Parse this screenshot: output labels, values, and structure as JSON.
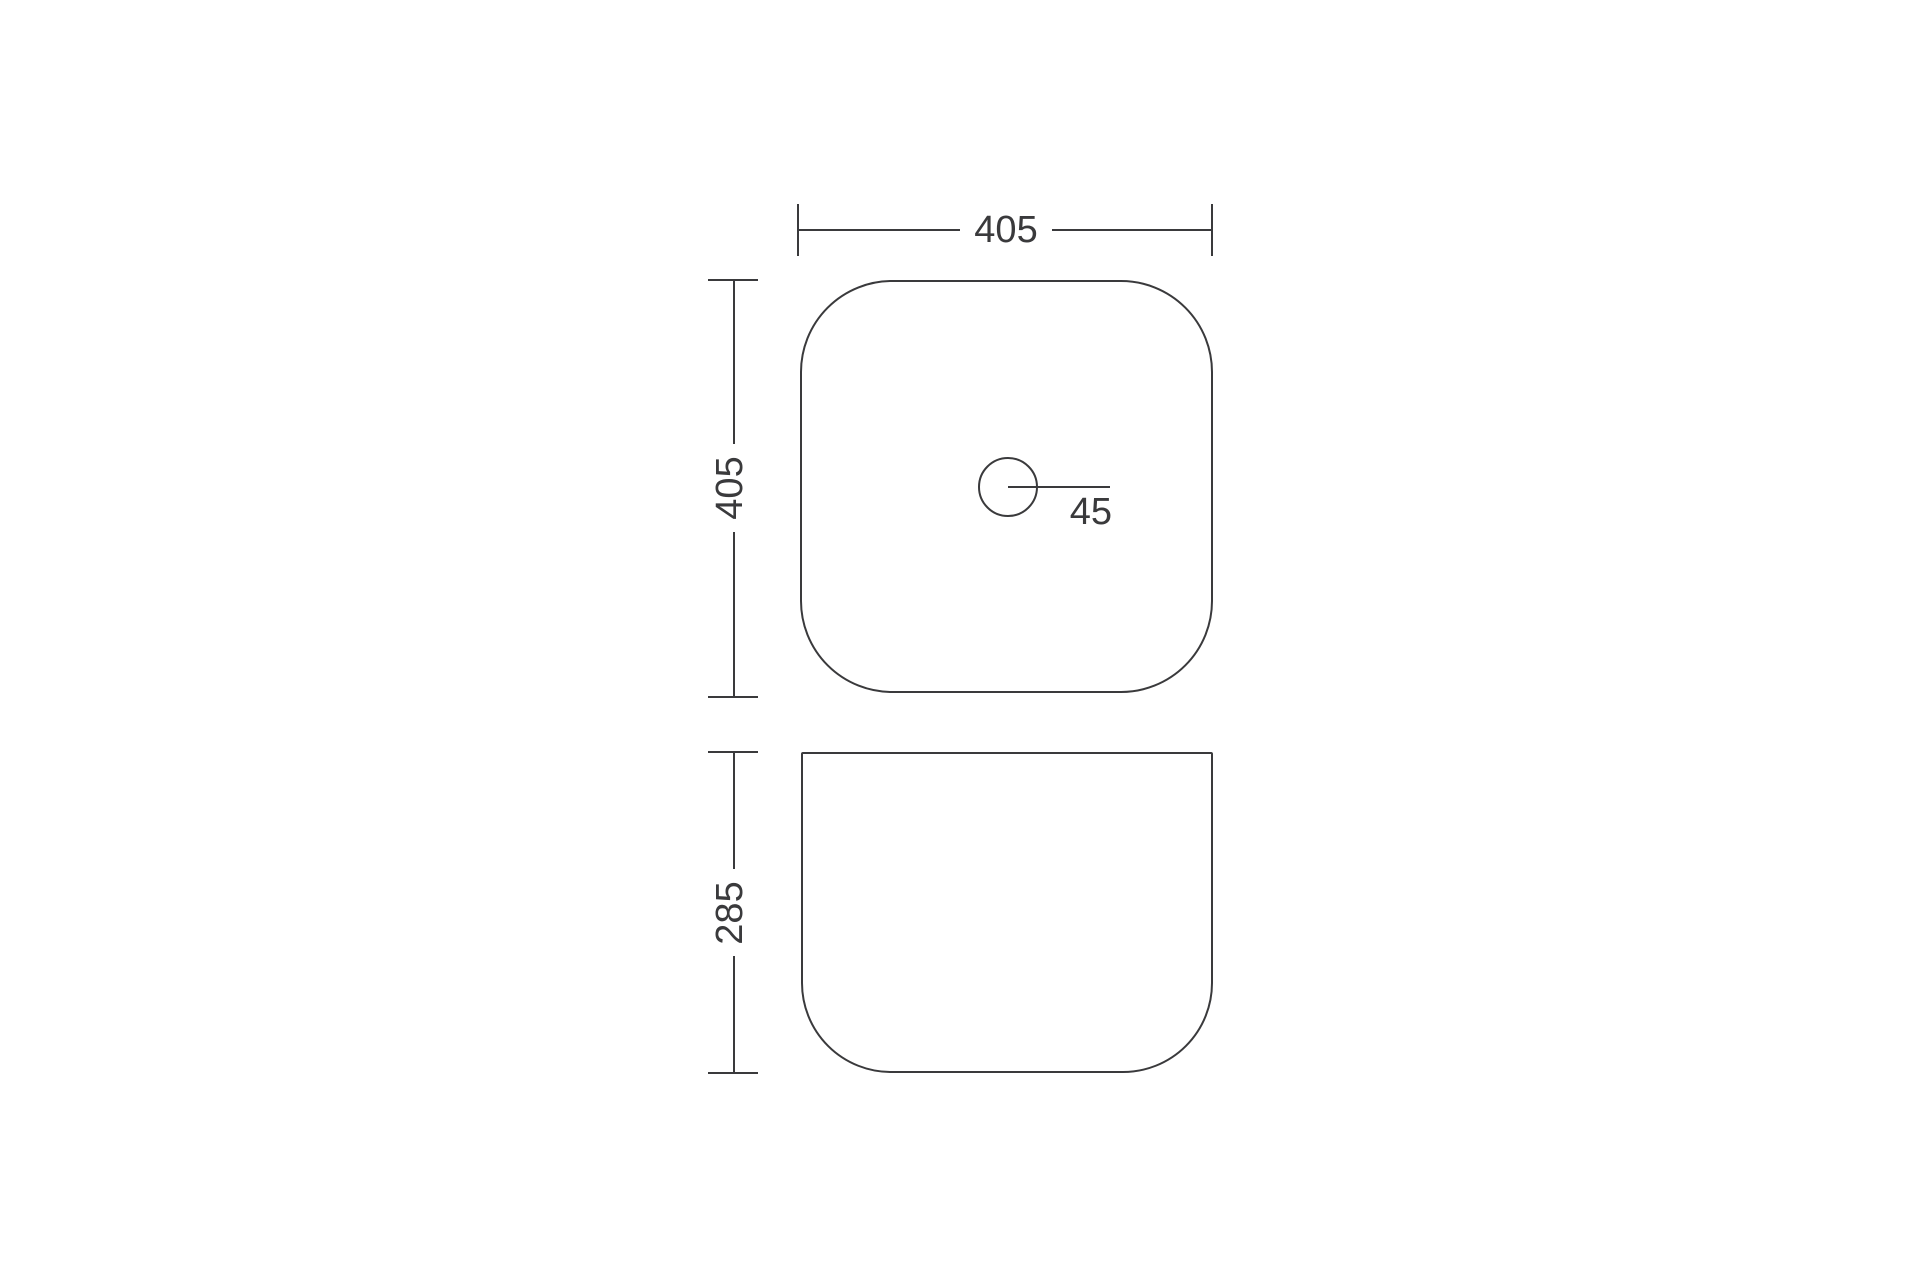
{
  "drawing": {
    "background_color": "#ffffff",
    "line_color": "#3a3a3c",
    "top_view": {
      "width_dimension": "405",
      "height_dimension": "405",
      "faucet_hole_dimension": "45"
    },
    "front_view": {
      "height_dimension": "285"
    }
  }
}
